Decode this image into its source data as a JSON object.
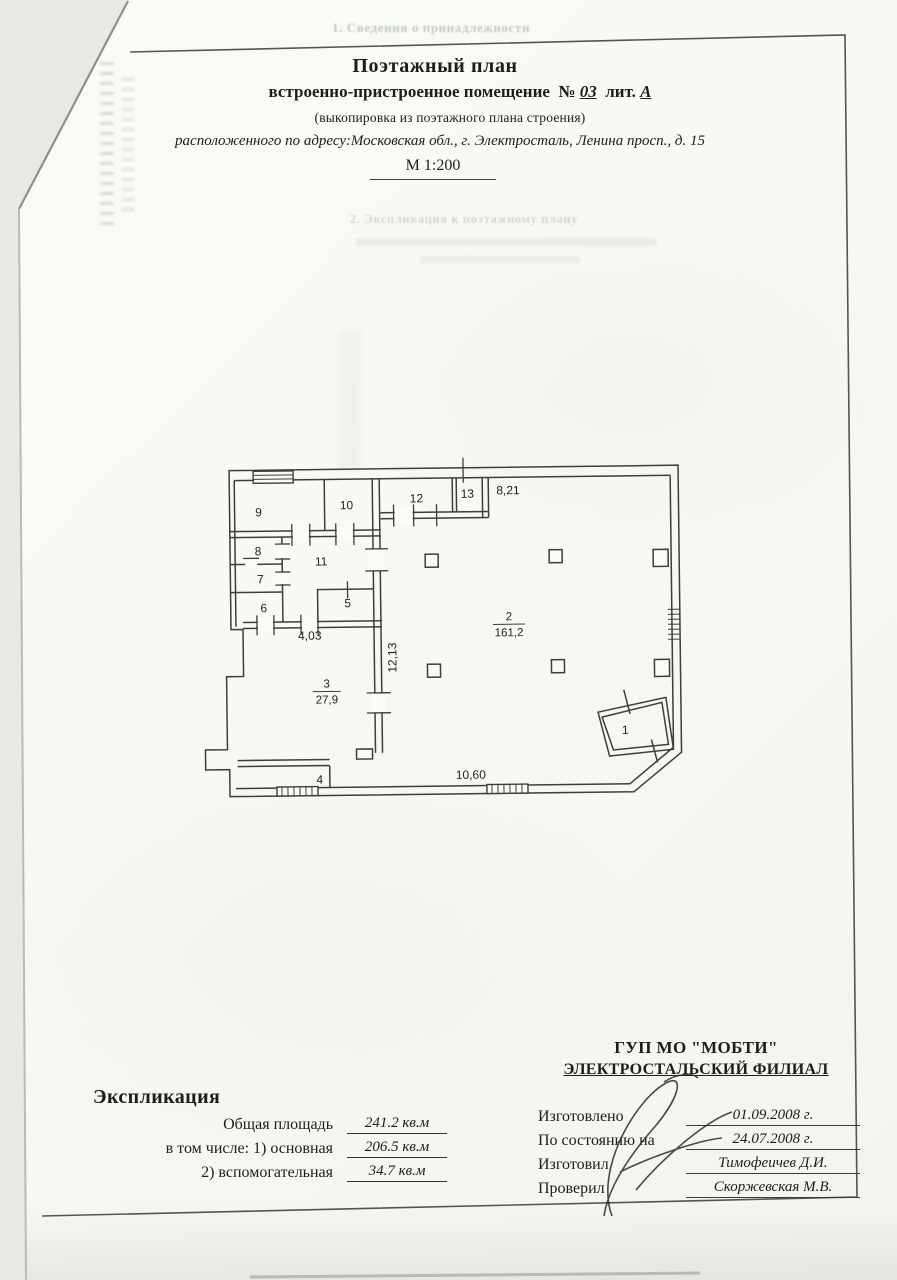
{
  "page": {
    "bleedthrough_top": "1. Сведения о принадлежности",
    "bleedthrough_middle": "2. Экспликация к поэтажному плану"
  },
  "header": {
    "title": "Поэтажный план",
    "subtitle_prefix": "встроенно-пристроенное помещение",
    "number_sign": "№",
    "number": "03",
    "liter_label": "лит.",
    "liter": "А",
    "subtitle_note": "(выкопировка из поэтажного плана строения)",
    "address_line": "расположенного по адресу:Московская обл., г. Электросталь, Ленина просп., д. 15",
    "scale": "М 1:200"
  },
  "plan": {
    "rooms": {
      "r1": "1",
      "r2": "2",
      "r3": "3",
      "r4": "4",
      "r5": "5",
      "r6": "6",
      "r7": "7",
      "r8": "8",
      "r9": "9",
      "r10": "10",
      "r11": "11",
      "r12": "12",
      "r13": "13"
    },
    "areas": {
      "room2": "161,2",
      "room3": "27,9"
    },
    "dimensions": {
      "top": "8,21",
      "vertical": "12,13",
      "middle": "4,03",
      "bottom": "10,60"
    }
  },
  "explication": {
    "title": "Экспликация",
    "rows": [
      {
        "label": "Общая площадь",
        "value": "241.2 кв.м"
      },
      {
        "label": "в том числе: 1) основная",
        "value": "206.5 кв.м"
      },
      {
        "label": "2) вспомогательная",
        "value": "34.7 кв.м"
      }
    ]
  },
  "organization": {
    "name_line1": "ГУП МО \"МОБТИ\"",
    "name_line2": "ЭЛЕКТРОСТАЛЬСКИЙ ФИЛИАЛ",
    "rows": [
      {
        "label": "Изготовлено",
        "value": "01.09.2008 г."
      },
      {
        "label": "По состоянию на",
        "value": "24.07.2008 г."
      },
      {
        "label": "Изготовил",
        "value": "Тимофеичев Д.И."
      },
      {
        "label": "Проверил",
        "value": "Скоржевская М.В."
      }
    ]
  },
  "colors": {
    "paper": "#fbfaf6",
    "background": "#e7e9e5",
    "ink": "#1d1d1b",
    "plan_line": "#3d3d3a"
  }
}
